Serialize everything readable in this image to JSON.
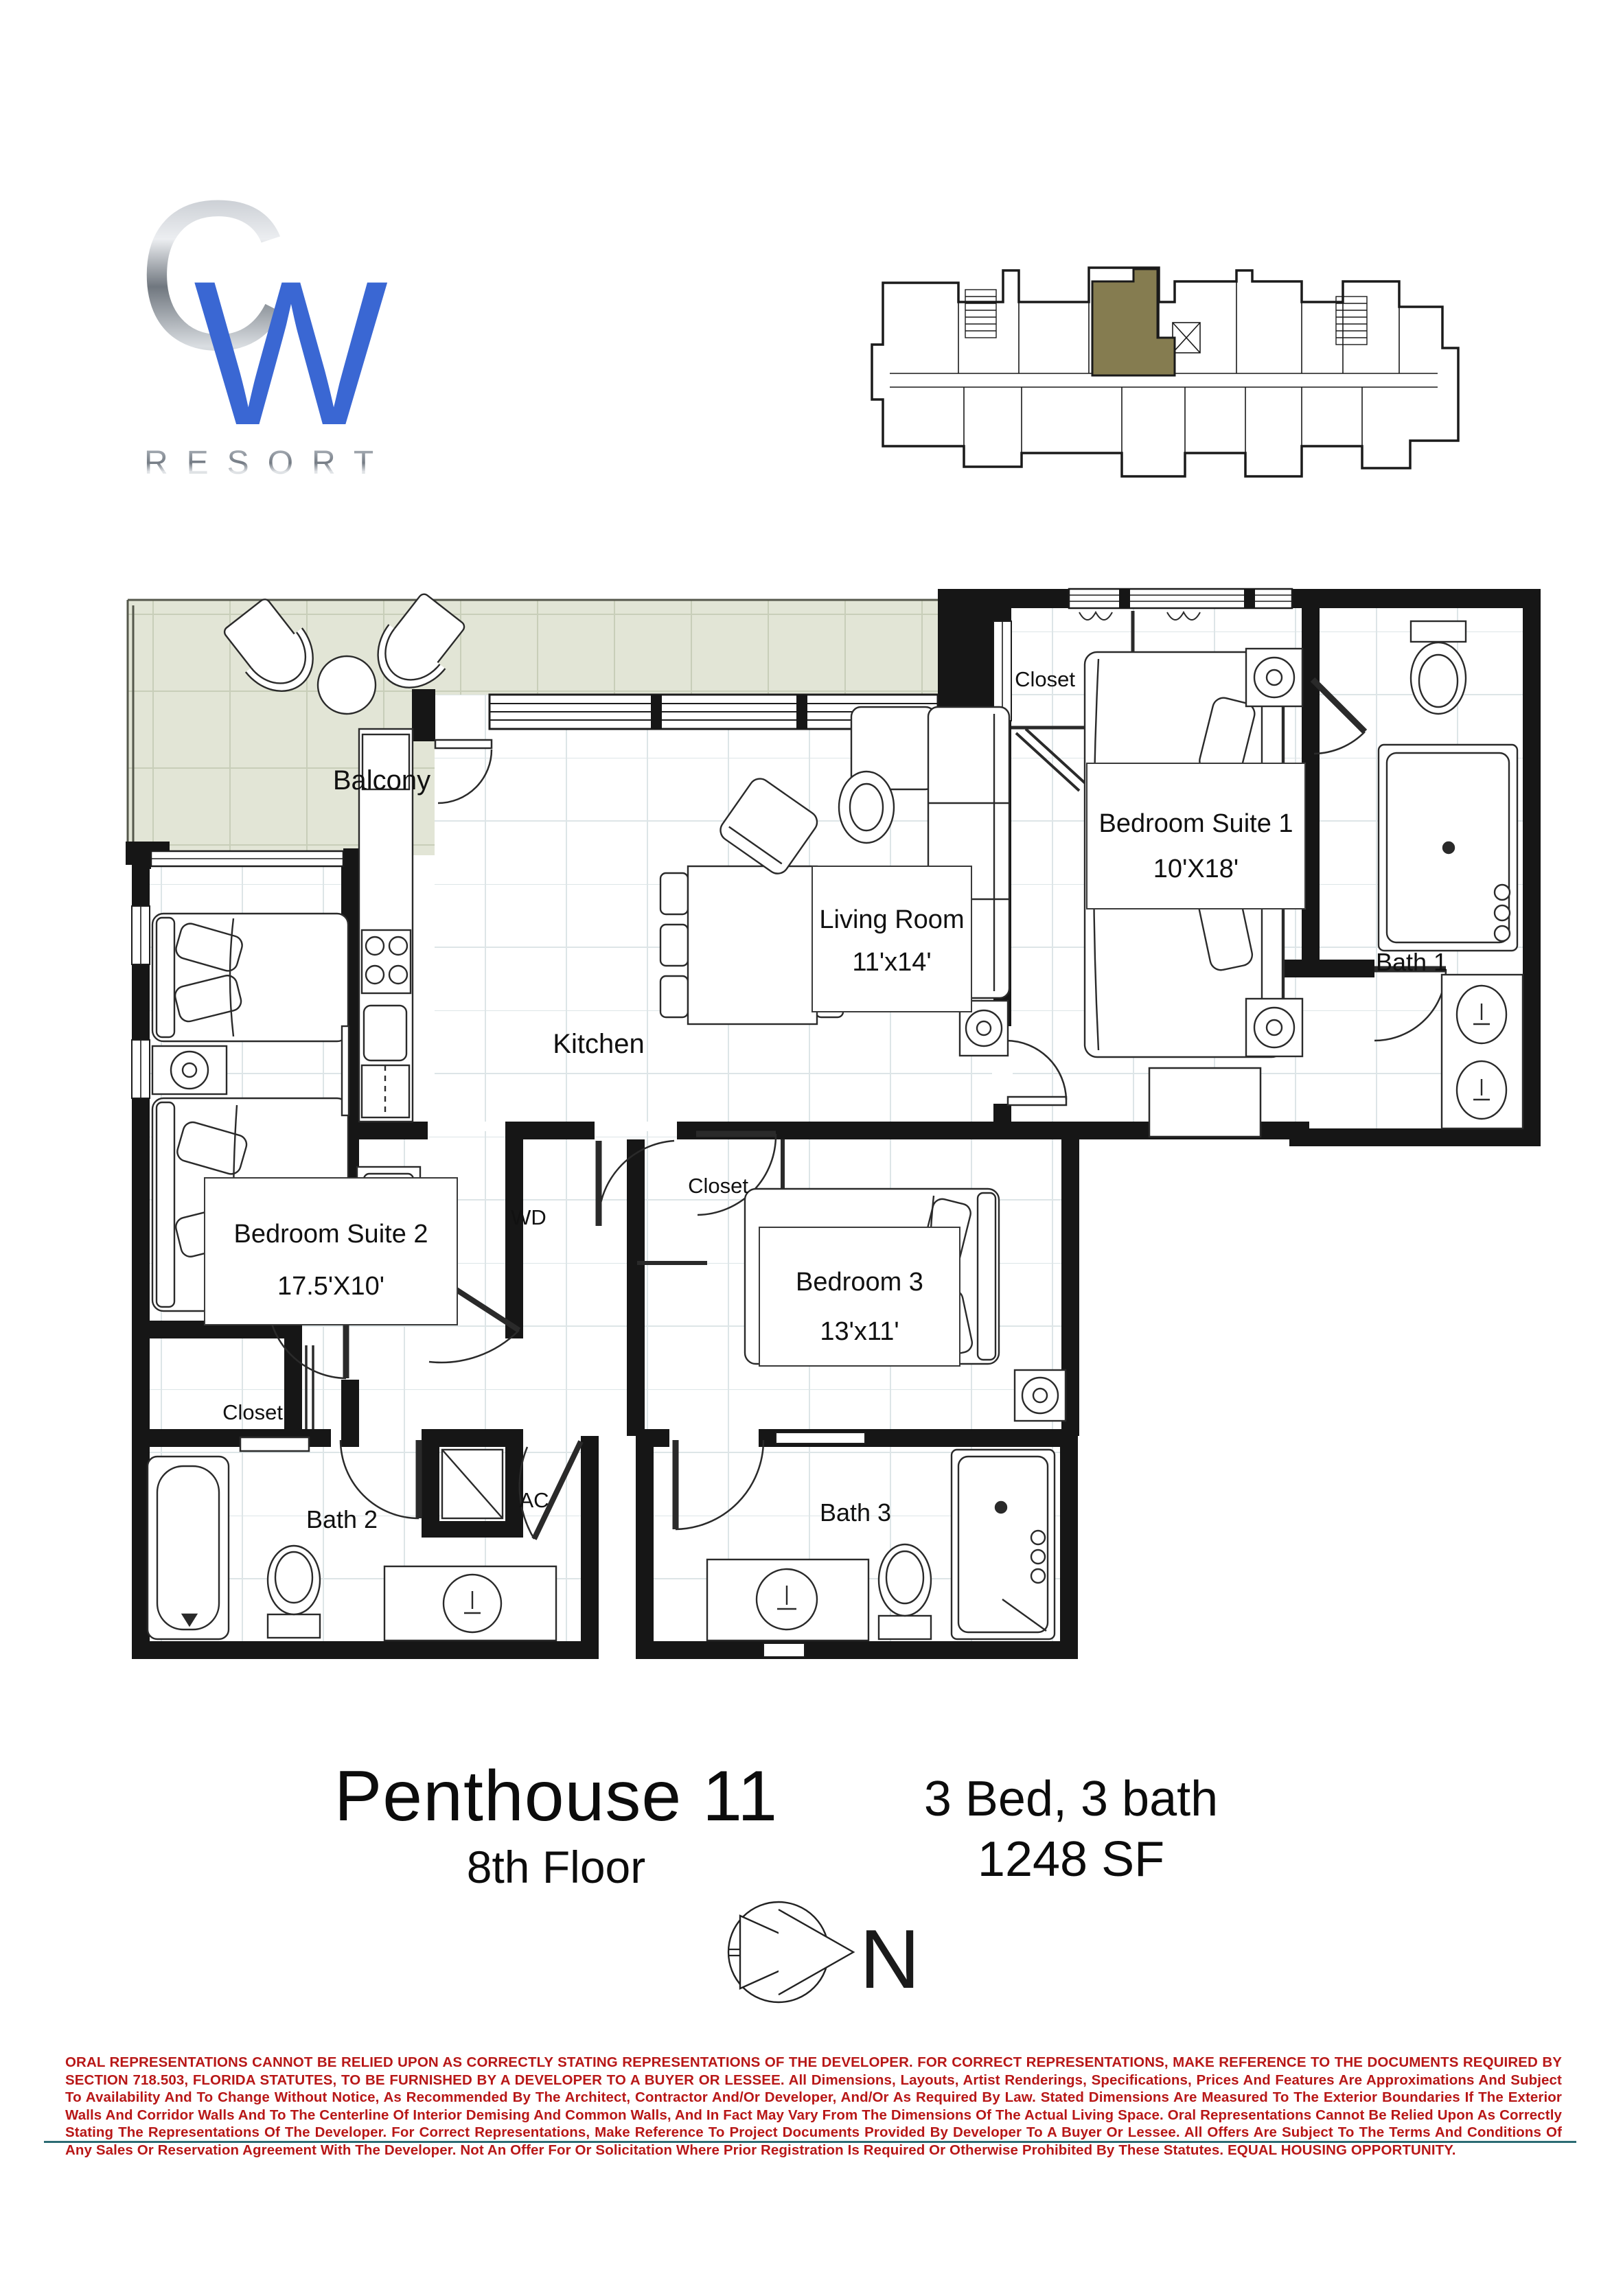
{
  "logo": {
    "letter_c": "C",
    "letter_w": "W",
    "word": "RESORT"
  },
  "key_plan": {
    "description": "building key plan with highlighted unit"
  },
  "plan": {
    "rooms": {
      "balcony": "Balcony",
      "living": {
        "name": "Living Room",
        "dims": "11'x14'"
      },
      "kitchen": "Kitchen",
      "suite1": {
        "name": "Bedroom Suite 1",
        "dims": "10'X18'"
      },
      "bath1": "Bath 1",
      "closet_suite1": "Closet",
      "suite2": {
        "name": "Bedroom Suite 2",
        "dims": "17.5'X10'"
      },
      "wd": "WD",
      "closet_bed3": "Closet",
      "bed3": {
        "name": "Bedroom 3",
        "dims": "13'x11'"
      },
      "closet_suite2": "Closet",
      "bath2": "Bath 2",
      "ac": "AC",
      "bath3": "Bath 3"
    }
  },
  "title_block": {
    "unit": "Penthouse 11",
    "floor": "8th Floor",
    "config": "3 Bed, 3 bath",
    "area": "1248 SF"
  },
  "compass": {
    "north": "N"
  },
  "disclaimer": {
    "text": "ORAL REPRESENTATIONS CANNOT BE RELIED UPON AS CORRECTLY STATING REPRESENTATIONS OF THE DEVELOPER. FOR CORRECT REPRESENTATIONS, MAKE REFERENCE TO THE DOCUMENTS REQUIRED BY SECTION 718.503, FLORIDA STATUTES, TO BE FURNISHED BY A DEVELOPER TO A BUYER OR LESSEE. All Dimensions, Layouts, Artist Renderings, Specifications, Prices And Features Are Approximations And Subject To Availability And To Change Without Notice, As Recommended By The Architect, Contractor And/Or Developer, And/Or As Required By Law. Stated Dimensions Are Measured To The Exterior Boundaries If The Exterior Walls And Corridor Walls And To The Centerline Of Interior Demising And Common Walls, And In Fact May Vary From The Dimensions Of The Actual Living Space. Oral Representations Cannot Be Relied Upon As Correctly Stating The Representations Of The Developer. For Correct Representations, Make Reference To Project Documents Provided By Developer To A Buyer Or Lessee. All Offers Are Subject To The Terms And Conditions Of Any Sales Or Reservation Agreement With The Developer. Not An Offer For Or Solicitation Where Prior Registration Is Required Or Otherwise Prohibited By These Statutes. EQUAL HOUSING OPPORTUNITY."
  },
  "colors": {
    "logo_blue": "#3a67d3",
    "logo_silver": "#9aa1a9",
    "key_plan_highlight": "#857c50",
    "balcony_floor": "#e2e5d6",
    "disclaimer_red": "#b81717",
    "rule_teal": "#2c6b73",
    "wall_black": "#161616"
  }
}
